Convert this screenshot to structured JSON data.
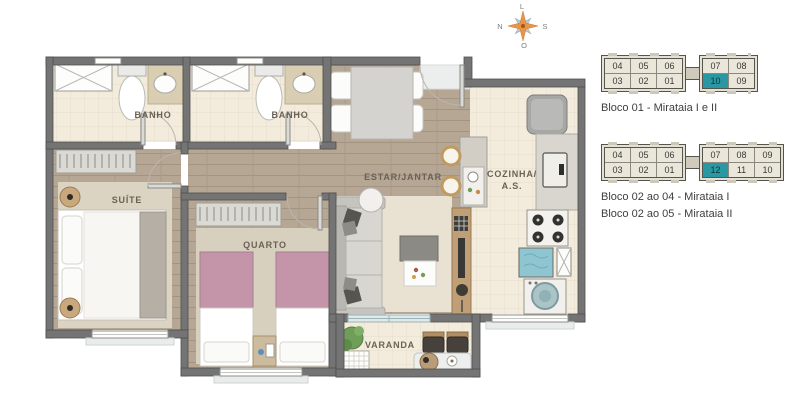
{
  "floorplan": {
    "labels": {
      "banho1": "BANHO",
      "banho2": "BANHO",
      "suite": "SUÍTE",
      "quarto": "QUARTO",
      "estar_jantar": "ESTAR/JANTAR",
      "cozinha_line1": "COZINHA/",
      "cozinha_line2": "A.S.",
      "varanda": "VARANDA"
    },
    "compass": {
      "top": "L",
      "right": "S",
      "bottom": "O",
      "left": "N"
    }
  },
  "unit_maps": [
    {
      "caption_lines": [
        "Bloco 01 - Mirataia I e II"
      ],
      "left_wing_rows": [
        [
          "04",
          "05",
          "06"
        ],
        [
          "03",
          "02",
          "01"
        ]
      ],
      "right_wing_rows": [
        [
          "07",
          "08"
        ],
        [
          "10",
          "09"
        ]
      ],
      "highlighted_unit": "10"
    },
    {
      "caption_lines": [
        "Bloco 02 ao 04 - Mirataia I",
        "Bloco 02 ao 05 - Mirataia II"
      ],
      "left_wing_rows": [
        [
          "04",
          "05",
          "06"
        ],
        [
          "03",
          "02",
          "01"
        ]
      ],
      "right_wing_rows": [
        [
          "07",
          "08",
          "09"
        ],
        [
          "12",
          "11",
          "10"
        ]
      ],
      "highlighted_unit": "12"
    }
  ],
  "colors": {
    "highlight_teal": "#2a98a3",
    "wall_gray": "#747474",
    "wood_floor": "#b6a694",
    "tile_floor": "#f3ecdd",
    "bedroom_pink": "#c495a8",
    "compass_orange": "#e8944a"
  }
}
